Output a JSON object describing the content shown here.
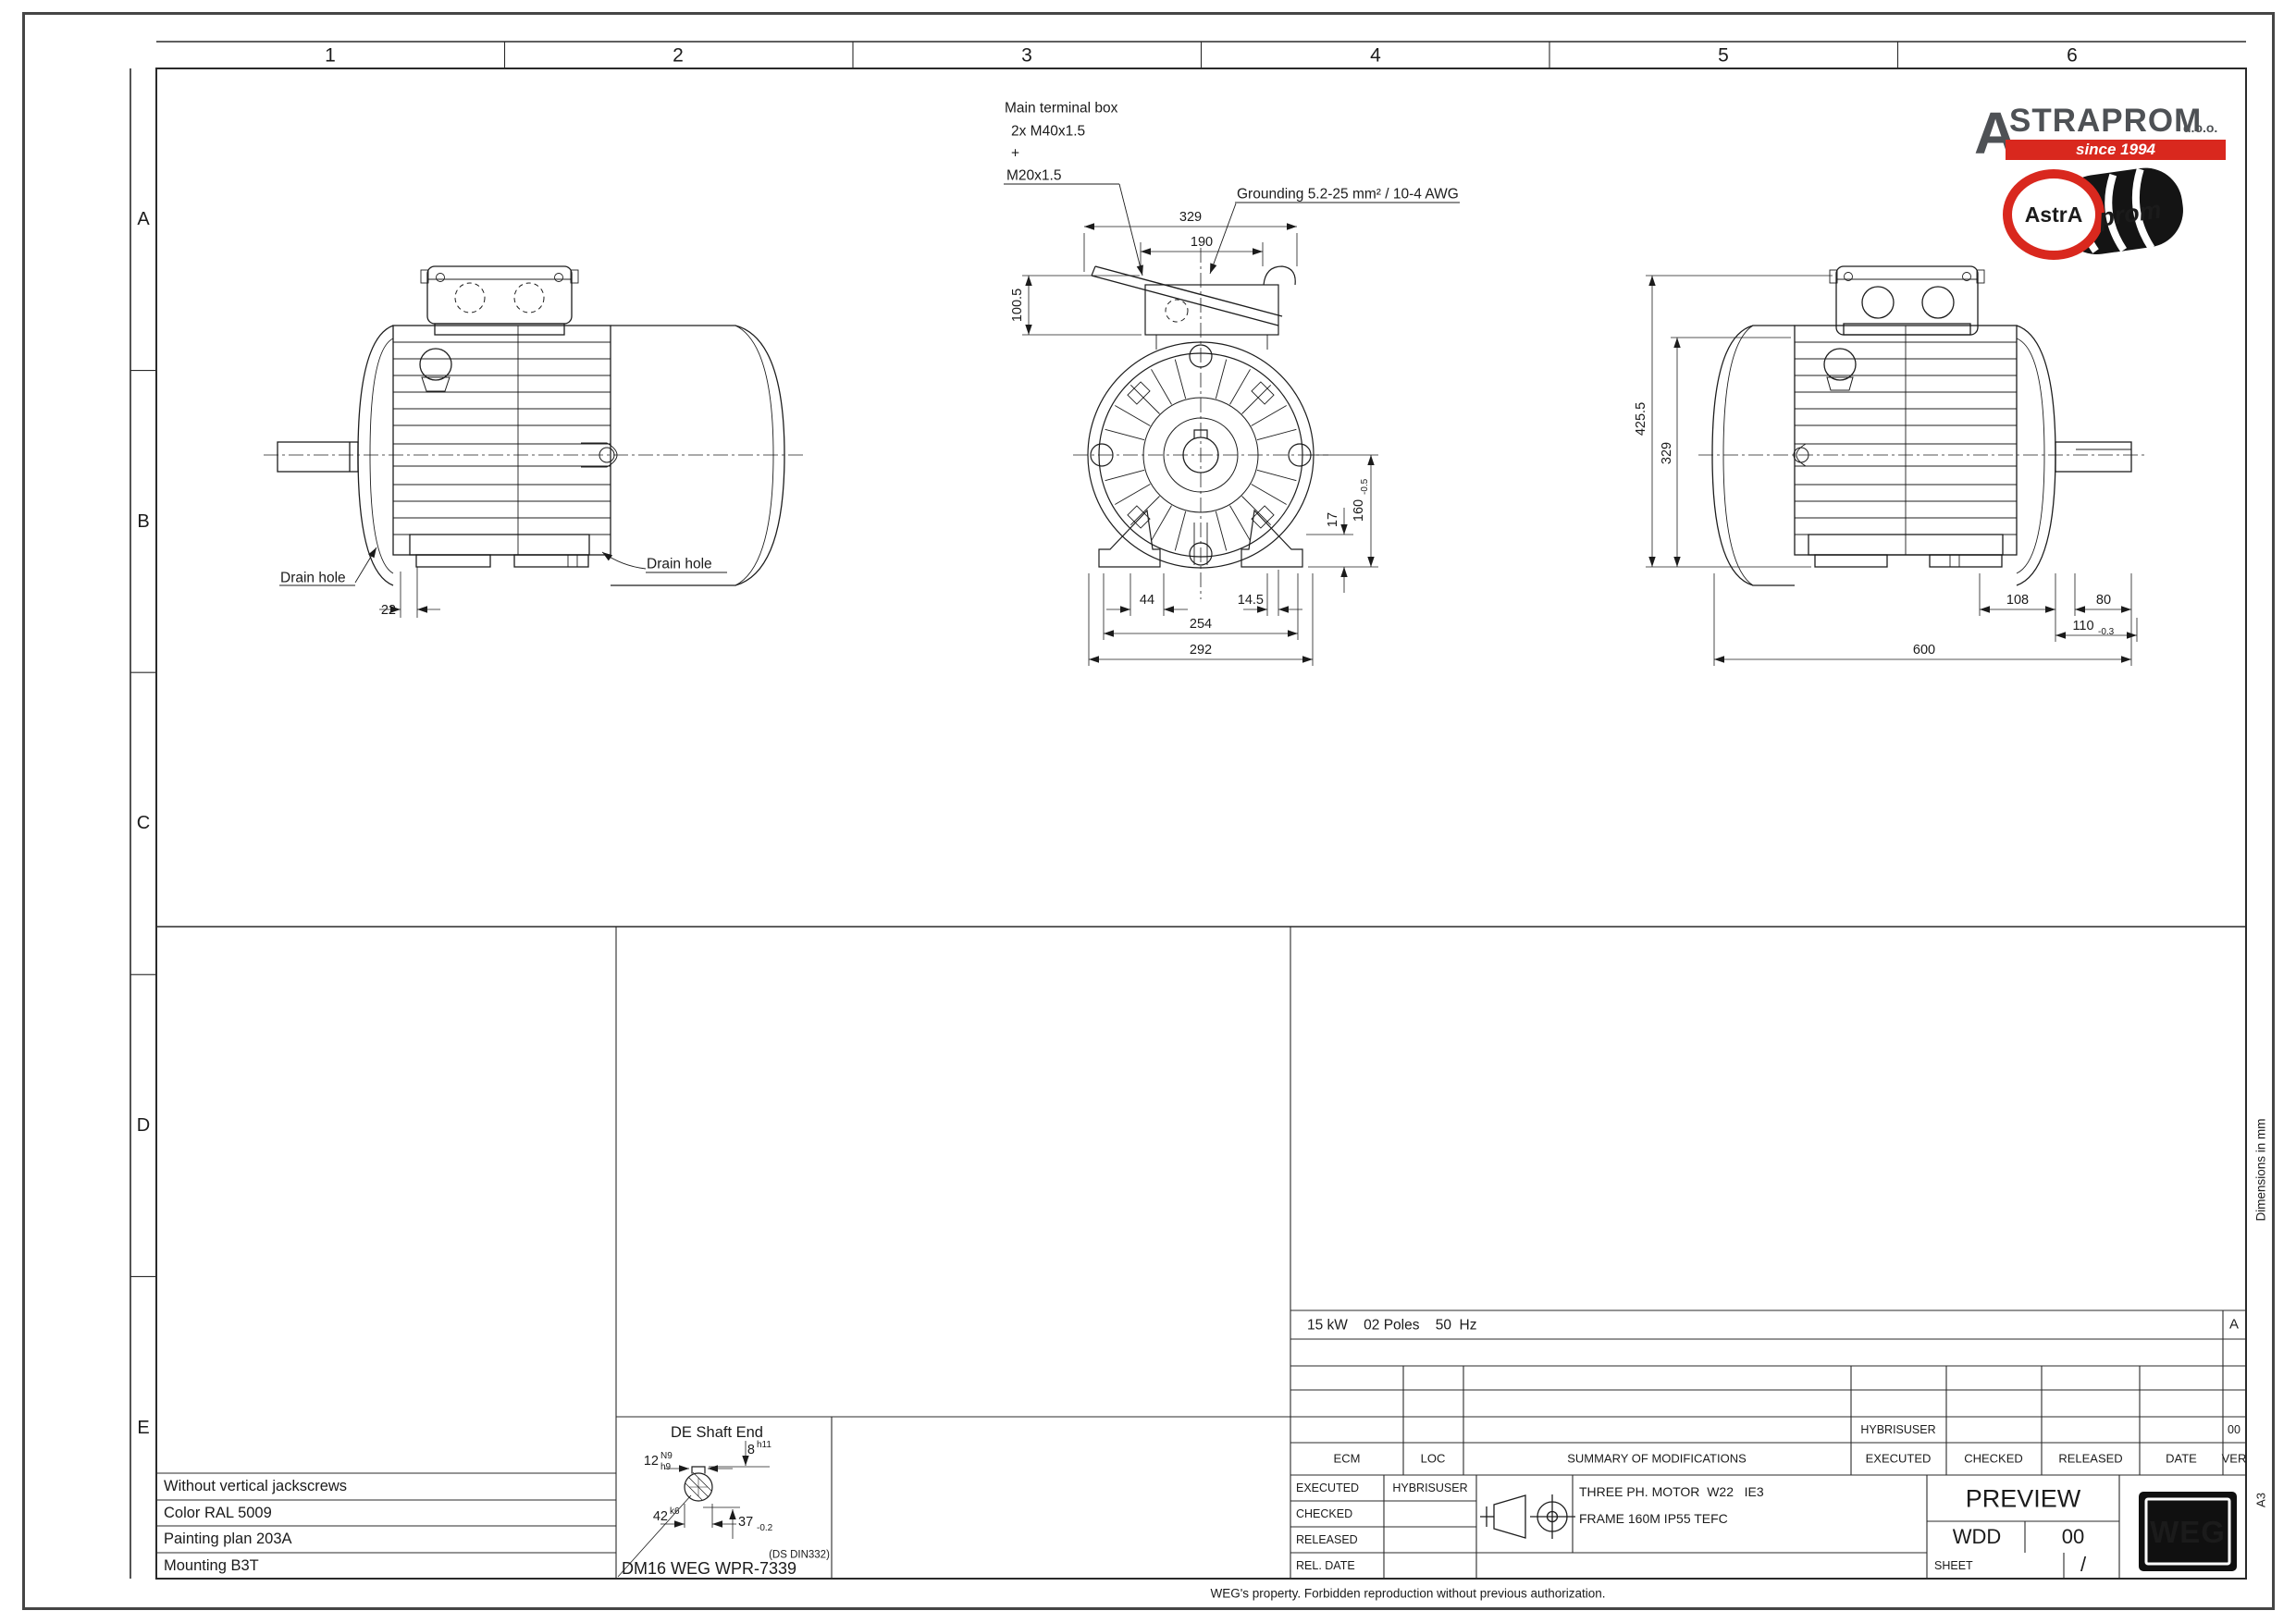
{
  "page": {
    "footer": "WEG's property. Forbidden reproduction without previous authorization.",
    "margin_note": "Dimensions in mm",
    "paper_size": "A3"
  },
  "frame": {
    "columns": [
      "1",
      "2",
      "3",
      "4",
      "5",
      "6"
    ],
    "rows": [
      "A",
      "B",
      "C",
      "D",
      "E"
    ]
  },
  "brand": {
    "initial": "A",
    "name": "STRAPROM",
    "suffix": "d.o.o.",
    "tagline": "since 1994",
    "badge_astra": "AstrA",
    "badge_prom": "prom",
    "red": "#d9281e",
    "gray": "#4e5155"
  },
  "callouts": {
    "terminal_box_line1": "Main terminal box",
    "terminal_box_line2": "2x M40x1.5",
    "terminal_box_line3": "+",
    "terminal_box_line4": "M20x1.5",
    "grounding": "Grounding 5.2-25 mm² / 10-4 AWG",
    "drain_hole_left": "Drain hole",
    "drain_hole_right": "Drain hole"
  },
  "dims": {
    "left_view": {
      "d22": "22"
    },
    "front_view": {
      "d329": "329",
      "d190": "190",
      "d100_5": "100.5",
      "d160": "160",
      "d160_tol": "-0.5",
      "d17": "17",
      "d44": "44",
      "d14_5": "14.5",
      "d254": "254",
      "d292": "292"
    },
    "right_view": {
      "d425_5": "425.5",
      "d329": "329",
      "d108": "108",
      "d80": "80",
      "d110": "110",
      "d110_tol": "-0.3",
      "d600": "600"
    }
  },
  "shaft_detail": {
    "title": "DE Shaft End",
    "d12": "12",
    "d12_sup": "N9",
    "d12_sub": "h9",
    "d8": "8",
    "d8_sup": "h11",
    "d42": "42",
    "d42_sup": "k6",
    "d37": "37",
    "d37_tol": "-0.2",
    "din_note": "(DS DIN332)",
    "center_hole": "DM16 WEG WPR-7339"
  },
  "notes": [
    "Without vertical jackscrews",
    "Color RAL 5009",
    "Painting plan 203A",
    "Mounting B3T"
  ],
  "rating": {
    "text": "15 kW    02 Poles    50  Hz",
    "revision": "A"
  },
  "revisions": {
    "headers": [
      "ECM",
      "LOC",
      "SUMMARY OF MODIFICATIONS",
      "EXECUTED",
      "CHECKED",
      "RELEASED",
      "DATE",
      "VER"
    ],
    "entry": {
      "executed": "HYBRISUSER",
      "ver": "00"
    }
  },
  "titleblock": {
    "executed_label": "EXECUTED",
    "executed_value": "HYBRISUSER",
    "checked_label": "CHECKED",
    "released_label": "RELEASED",
    "rel_date_label": "REL. DATE",
    "desc_line1": "THREE PH. MOTOR  W22   IE3",
    "desc_line2": "FRAME 160M IP55 TEFC",
    "status": "PREVIEW",
    "doc_type": "WDD",
    "doc_ver": "00",
    "sheet_label": "SHEET",
    "sheet_value": "/",
    "weg_logo": "WEG"
  }
}
